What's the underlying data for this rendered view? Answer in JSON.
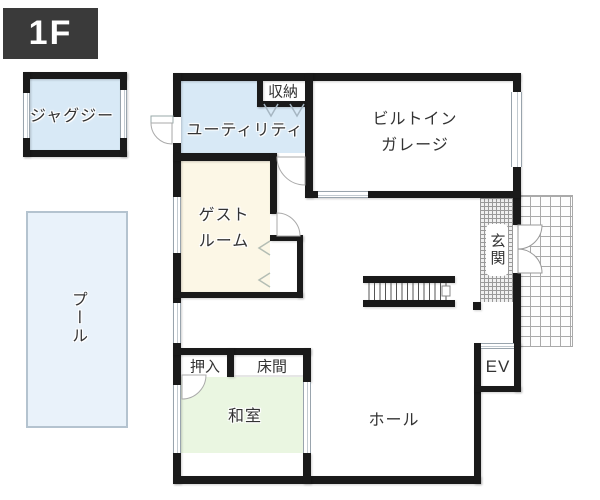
{
  "floor_badge": {
    "label": "1F"
  },
  "rooms": {
    "jacuzzi": {
      "label": "ジャグジー"
    },
    "pool": {
      "label": "プール"
    },
    "utility": {
      "label": "ユーティリティ"
    },
    "storage": {
      "label": "収納"
    },
    "garage": {
      "label_line1": "ビルトイン",
      "label_line2": "ガレージ"
    },
    "guest_room": {
      "label_line1": "ゲスト",
      "label_line2": "ルーム"
    },
    "entrance": {
      "label": "玄関"
    },
    "oshiire": {
      "label": "押入"
    },
    "tokonoma": {
      "label": "床間"
    },
    "japanese_room": {
      "label": "和室"
    },
    "hall": {
      "label": "ホール"
    },
    "elevator": {
      "label": "EV"
    }
  },
  "colors": {
    "wall": "#1a1a1a",
    "water_room_fill": "#d8e9f6",
    "pool_fill": "#e9f2fa",
    "guest_room_fill": "#fcf7e6",
    "japanese_room_fill": "#eaf6e1",
    "badge_bg": "#3a3a3a",
    "badge_text": "#ffffff",
    "label_text": "#333333"
  }
}
